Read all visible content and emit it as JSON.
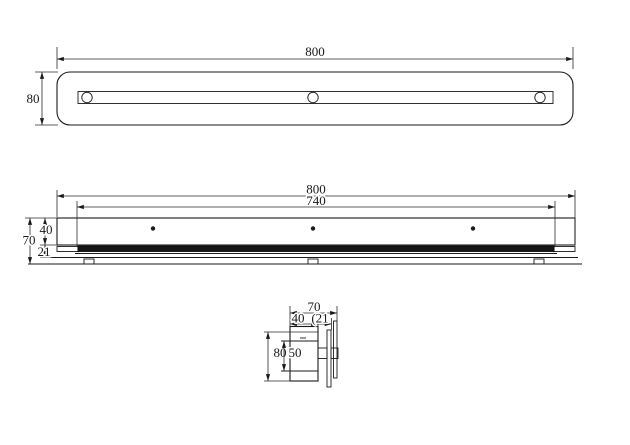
{
  "views": {
    "top": {
      "width": "800",
      "depth": "80"
    },
    "front": {
      "width": "800",
      "inner_width": "740",
      "total_height": "70",
      "body_height": "40",
      "rail_height": "21"
    },
    "side": {
      "width": "70",
      "body_depth": "40",
      "plate_offset": "(21",
      "height": "80",
      "inner_height": "50"
    }
  }
}
